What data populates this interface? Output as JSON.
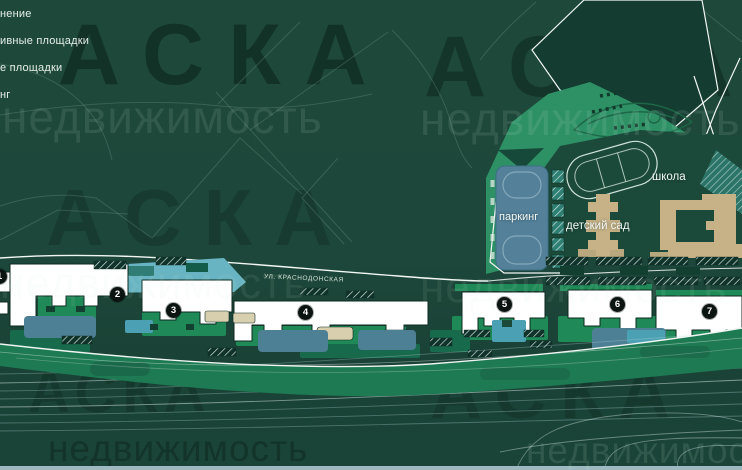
{
  "brand": {
    "watermark_title": "АСКА",
    "watermark_subtitle": "недвижимость"
  },
  "legend": {
    "items": [
      "нение",
      "ивные площадки",
      "е площадки",
      "нг"
    ]
  },
  "map": {
    "street_label": "УЛ. КРАСНОДОНСКАЯ",
    "labels": {
      "parking": "паркинг",
      "kindergarten": "детский сад",
      "school": "школа"
    },
    "badges": [
      {
        "number": "1"
      },
      {
        "number": "2"
      },
      {
        "number": "3"
      },
      {
        "number": "4"
      },
      {
        "number": "5"
      },
      {
        "number": "6"
      },
      {
        "number": "7"
      }
    ],
    "colors": {
      "background": "#1d473a",
      "park_green": "#2e9166",
      "campus_green": "#1c4a3a",
      "building_white": "#ffffff",
      "civic_tan": "#c7b287",
      "parking_blue": "#54809a",
      "playground_teal": "#4ba0b4",
      "infra_steel": "#4d7f95",
      "courtyard_green": "#1f8a58",
      "badge_black": "#0b1410",
      "track_line": "#bcd8db",
      "shore_strip": "#9fb9c2"
    }
  }
}
